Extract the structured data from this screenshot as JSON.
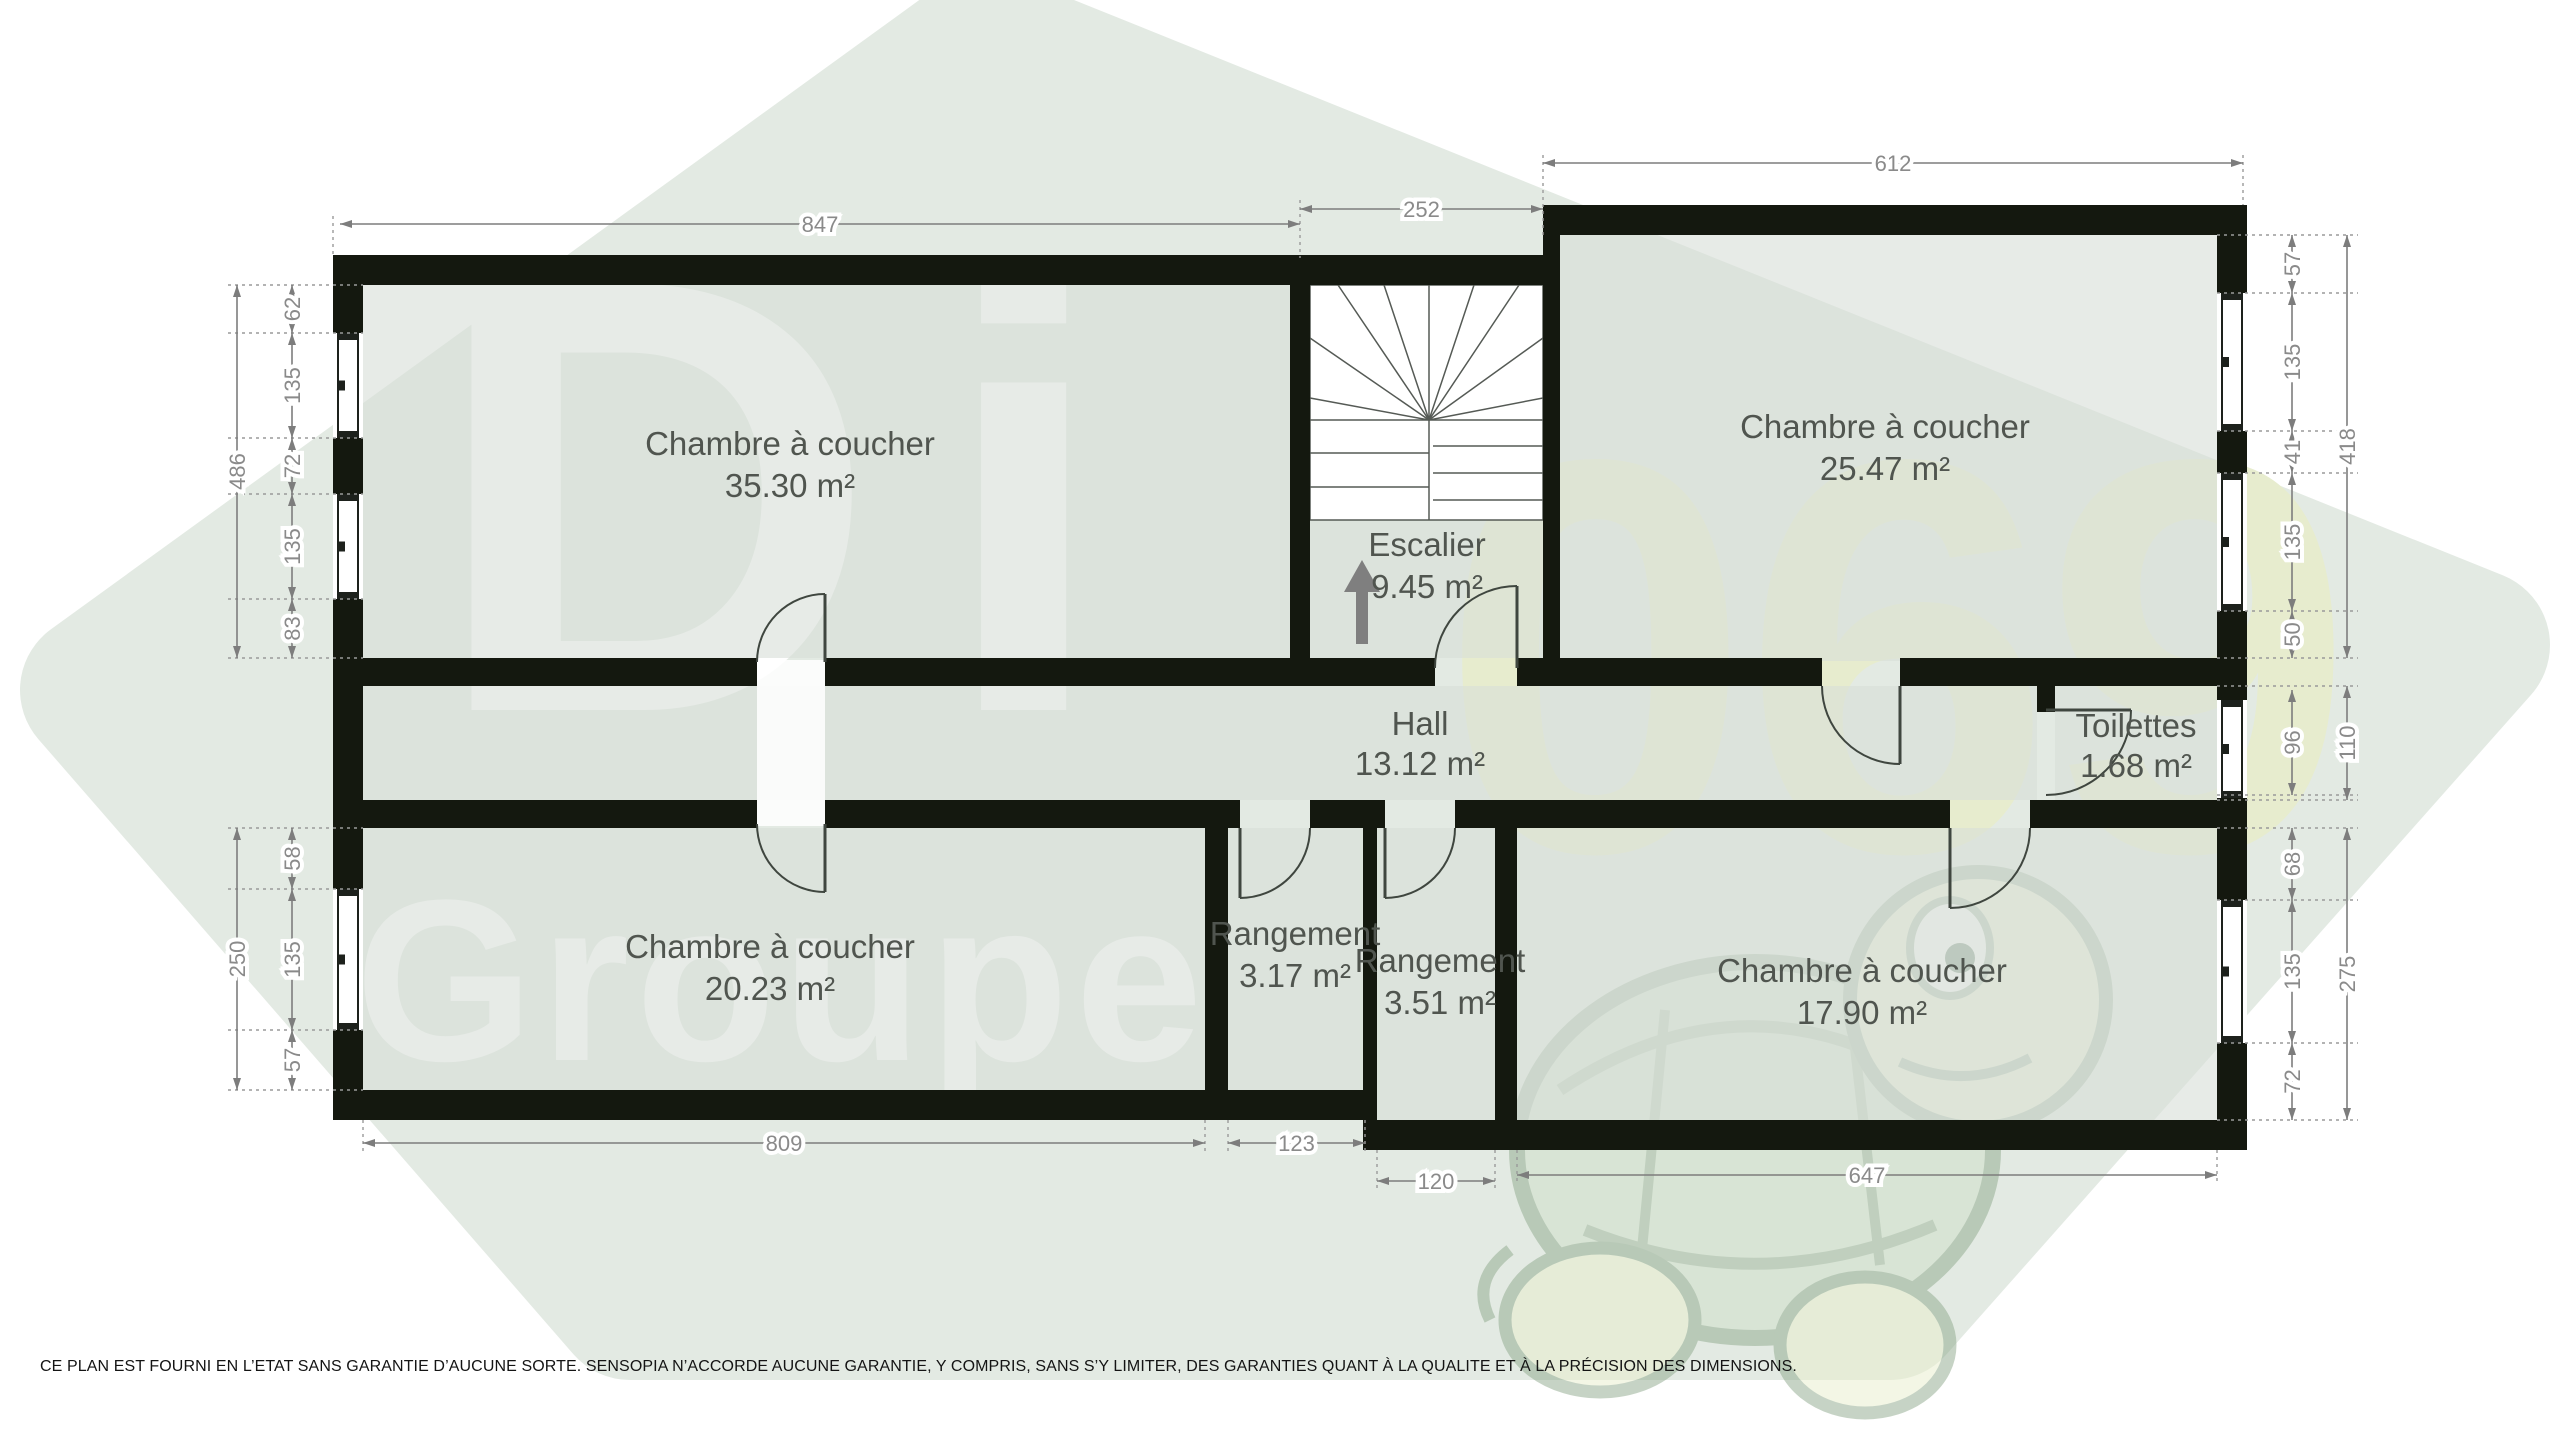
{
  "watermark": {
    "brand_line1": "Di",
    "brand_line2": "Groupe",
    "number": "069",
    "hexagon_color": "#e3eae3",
    "number_color": "#e7ecce",
    "brand_color": "#ffffff"
  },
  "colors": {
    "wall": "#14180f",
    "room_fill": "#d9ded9",
    "dimension_gray": "#7d7d7d",
    "label_gray": "#50554f"
  },
  "rooms": {
    "bedroom_tl": {
      "name": "Chambre à coucher",
      "area": "35.30 m²"
    },
    "stairs": {
      "name": "Escalier",
      "area": "9.45 m²"
    },
    "bedroom_tr": {
      "name": "Chambre à coucher",
      "area": "25.47 m²"
    },
    "hall": {
      "name": "Hall",
      "area": "13.12 m²"
    },
    "toilet": {
      "name": "Toilettes",
      "area": "1.68 m²"
    },
    "bedroom_bl": {
      "name": "Chambre à coucher",
      "area": "20.23 m²"
    },
    "storage1": {
      "name": "Rangement",
      "area": "3.17 m²"
    },
    "storage2": {
      "name": "Rangement",
      "area": "3.51 m²"
    },
    "bedroom_br": {
      "name": "Chambre à coucher",
      "area": "17.90 m²"
    }
  },
  "dimensions": {
    "top": [
      "847",
      "252",
      "612"
    ],
    "bottom": [
      "809",
      "123",
      "120",
      "647"
    ],
    "left_upper": [
      "62",
      "135",
      "72",
      "135",
      "83"
    ],
    "left_upper_total": "486",
    "left_lower": [
      "58",
      "135",
      "57"
    ],
    "left_lower_total": "250",
    "right_upper": [
      "57",
      "135",
      "41",
      "135",
      "50"
    ],
    "right_upper_total": "418",
    "right_mid": [
      "96"
    ],
    "right_mid_total": "110",
    "right_lower": [
      "68",
      "135",
      "72"
    ],
    "right_lower_total": "275"
  },
  "disclaimer": "CE PLAN EST FOURNI EN L’ETAT SANS GARANTIE D’AUCUNE SORTE. SENSOPIA N’ACCORDE AUCUNE GARANTIE, Y COMPRIS, SANS S’Y LIMITER, DES GARANTIES QUANT À LA QUALITE ET À LA PRÉCISION DES DIMENSIONS."
}
